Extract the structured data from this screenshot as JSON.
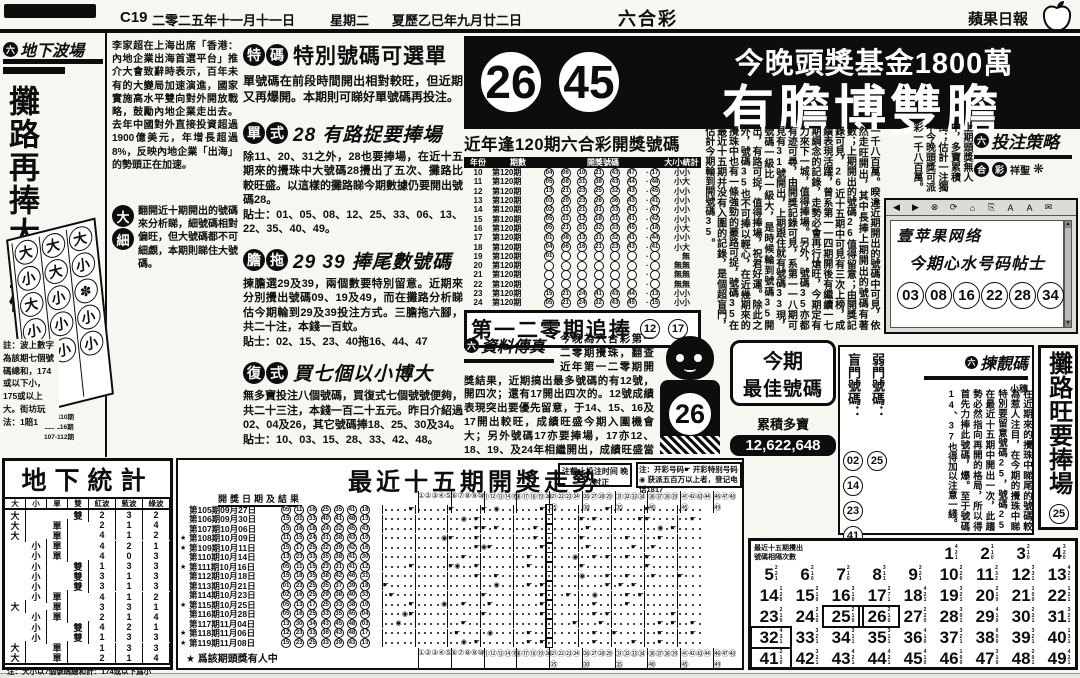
{
  "palette": {
    "ink": "#0d0d0d",
    "paper": "#f7f6f1"
  },
  "header": {
    "page": "C19",
    "date": "二零二五年十一月十一日",
    "weekday": "星期二",
    "lunar": "夏歷乙巳年九月廿二日",
    "section": "六合彩",
    "paper_name": "蘋果日報"
  },
  "left": {
    "logo_prefix": "六",
    "logo": "地下波場",
    "title": "攤路再捧大號碼",
    "board": {
      "rows": [
        [
          "大",
          "大",
          "大"
        ],
        [
          "小",
          "大",
          "小"
        ],
        [
          "大",
          "小",
          "✽"
        ],
        [
          "小",
          "小",
          "小"
        ],
        [
          "小",
          "小",
          "小"
        ]
      ],
      "labels": [
        "105-110期",
        "111-116期",
        "107-112期"
      ]
    },
    "note": "註：波上數字為該期七個號碼總和，174或以下小，175或以上大。街坊玩法：1賠1"
  },
  "news": "李家超在上海出席「香港：內地企業出海首選平台」推介大會致辭時表示，百年未有的大變局加速演進，國家實施高水平雙向對外開放戰略，鼓勵內地企業走出去。去年中國對外直接投資超過1900億美元，年增長超過8%，反映內地企業「出海」的勢頭正在加速。",
  "fan": {
    "badge_top": "大",
    "badge_bottom": "細",
    "text": "翻開近十期開出的號碼來分析睇，細號碼相對偏旺，但大號碼都不可細覷，本期則睇住大號碼。"
  },
  "sections": [
    {
      "badge": "特碼",
      "title": "特別號碼可選單",
      "body": "單號碼在前段時間開出相對較旺，但近期又再爆開。本期則可睇好單號碼再投注。",
      "tips": ""
    },
    {
      "badge": "單式",
      "title": "28 有路捉要捧場",
      "body": "除11、20、31之外，28也要捧場，在近十五期來的攪珠中大號碼28攪出了五次、攤路比較旺盛。以這樣的攤路睇今期數據仍要開出號碼28。",
      "tips": "貼士：01、05、08、12、25、33、06、13、22、35、40、49。"
    },
    {
      "badge": "膽拖",
      "title": "29 39 捧尾數號碼",
      "body": "揀膽選29及39，兩個數要特別留意。近期來分別攪出號碼09、19及49，而在攤路分析睇估今期輪到29及39投注方式。三膽拖六腳，共二十注，本錢一百蚊。",
      "tips": "貼士：02、15、23、40拖16、44、47"
    },
    {
      "badge": "復式",
      "title": "買七個以小博大",
      "body": "無多寶投注八個號碼，買復式七個號號便夠，共二十三注，本錢一百二十五元。昨日介紹過02、04及26，其它號碼捧18、25、30及34。",
      "tips": "貼士：10、03、15、28、33、42、48。"
    }
  ],
  "banner": {
    "balls": [
      "26",
      "45"
    ],
    "line1": "今晚頭獎基金1800萬",
    "line2": "有膽博雙膽"
  },
  "l120": {
    "title": "近年逢120期六合彩開獎號碼",
    "headers": [
      "年份",
      "期數",
      "開獎號碼",
      "大/小統計"
    ],
    "rows": [
      {
        "y": "10",
        "i": "第120期",
        "n": [
          "04",
          "06",
          "10",
          "21",
          "43",
          "47"
        ],
        "s": "17",
        "t": "小小"
      },
      {
        "y": "11",
        "i": "第120期",
        "n": [
          "05",
          "08",
          "31",
          "38",
          "43",
          "44"
        ],
        "s": "48",
        "t": "小大"
      },
      {
        "y": "12",
        "i": "第120期",
        "n": [
          "13",
          "21",
          "23",
          "25",
          "32",
          "43"
        ],
        "s": "45",
        "t": "小小"
      },
      {
        "y": "13",
        "i": "第120期",
        "n": [
          "03",
          "20",
          "23",
          "26",
          "36",
          "43"
        ],
        "s": "41",
        "t": "小小"
      },
      {
        "y": "14",
        "i": "第120期",
        "n": [
          "02",
          "11",
          "21",
          "31",
          "33",
          "41"
        ],
        "s": "47",
        "t": "小小"
      },
      {
        "y": "15",
        "i": "第120期",
        "n": [
          "05",
          "11",
          "12",
          "18",
          "31",
          "41"
        ],
        "s": "42",
        "t": "小小"
      },
      {
        "y": "16",
        "i": "第120期",
        "n": [
          "05",
          "21",
          "31",
          "32",
          "33",
          "45"
        ],
        "s": "18",
        "t": "小大"
      },
      {
        "y": "17",
        "i": "第120期",
        "n": [
          "01",
          "08",
          "13",
          "31",
          "32",
          "41"
        ],
        "s": "44",
        "t": "小小"
      },
      {
        "y": "18",
        "i": "第120期",
        "n": [
          "04",
          "06",
          "16",
          "21",
          "23",
          "43"
        ],
        "s": "41",
        "t": "小大"
      },
      {
        "y": "19",
        "i": "第120期",
        "n": [
          "01",
          "",
          "",
          "",
          "",
          ""
        ],
        "s": "",
        "t": "無"
      },
      {
        "y": "20",
        "i": "第120期",
        "n": [
          "",
          "",
          "",
          "",
          "",
          ""
        ],
        "s": "",
        "t": "無無"
      },
      {
        "y": "21",
        "i": "第120期",
        "n": [
          "",
          "",
          "",
          "",
          "",
          ""
        ],
        "s": "",
        "t": "無無"
      },
      {
        "y": "22",
        "i": "第120期",
        "n": [
          "",
          "",
          "",
          "",
          "",
          ""
        ],
        "s": "",
        "t": "無無"
      },
      {
        "y": "23",
        "i": "第120期",
        "n": [
          "15",
          "21",
          "24",
          "41",
          "43",
          "44"
        ],
        "s": "13",
        "t": "小小"
      },
      {
        "y": "24",
        "i": "第120期",
        "n": [
          "05",
          "21",
          "24",
          "32",
          "43",
          "45"
        ],
        "s": "15",
        "t": "小小"
      }
    ],
    "chase": "第一二零期追捧",
    "chase_balls": [
      "12",
      "17"
    ]
  },
  "column_article": "一千八百萬。暌違近期開出的號碼中可見，依然走旺開出，其中長捧上期開出的號碼有著數；上期開出的號碼26值得留意；由開獎記錄可見，26近十五期中可見有三次上榜，成績表現活躍，曾系第一一四期開後有繼續一七期綱念的記錄，走勢必會再行熗旺，今期定有力來下一城，值得捧場。另外，號碼35亦都有迹可尋，由開獎記錄可見，系第一一八期可見有31號開出，上期跟住就有號碼33現，號碼一級比一級大，是時候輪到號碼35開出，有路可捉，值得捧場，祝君好運。除此之外，號碼35也不可捧以輕心，在近幾期來的攪珠中也有一條強勁的叢路可捉，號碼35在最近十五期并没有入圍的記錄，是個超盲門，估計今期輪到開號碼35。",
  "fax": {
    "logo_prefix": "六",
    "logo": "資料傳真",
    "body": "今晚為六合彩第一二零期攪珠，翻查近年第一二零期開獎結果，近期搞出最多號碼的有12號，開四次；還有17開出四次的。12號成績表現突出要優先留意，于14、15、16及17開出較旺，成績旺盛今期入圍機會大；另外號碼17亦要捧場，17亦12、18、19、及24年相繼開出，成績旺盛當為首選。",
    "best_line1": "今期",
    "best_line2": "最佳號碼",
    "jackpot_label": "累積多寶",
    "jackpot": "12,622,648",
    "boy_number": "26"
  },
  "strategy": {
    "snippet": "上期頭獎無人中，多寶累積萬；估計一注獨中今晚頭獎可派彩一千八百萬。",
    "logo_prefix": "六",
    "logo": "投注策略",
    "sub1": "合",
    "sub2": "彩",
    "sub3": "祥聖"
  },
  "web": {
    "site": "壹苹果网络",
    "title": "今期心水号码帖士",
    "numbers": [
      "03",
      "08",
      "16",
      "22",
      "28",
      "34"
    ],
    "toolbar": [
      "◀",
      "▶",
      "⊗",
      "⟳",
      "⌂",
      "⎘",
      "A",
      "A",
      "✉"
    ]
  },
  "pick": {
    "logo_prefix": "六",
    "logo": "揀靚碼",
    "author": "小穗",
    "blind_label": "盲門號碼：",
    "blind": [
      "02",
      "14",
      "23",
      "41"
    ],
    "weak_label": "弱門號碼：",
    "weak": "25",
    "article": "在近期來的攪珠中睇尾的號碼較為惹人注目，在今期的攪珠中睇特別要留意號碼25，號碼25在最近十五期中開出一次，此趨勢必然指向再開的格局，所以得首先力捧此號碼，爆。至于號碼14、37也得加以注意一綫。"
  },
  "strip": {
    "title": "攤路旺要捧場",
    "number": "25"
  },
  "underground": {
    "title": "地下統計",
    "headers": [
      "大",
      "小",
      "單",
      "雙",
      "紅波",
      "藍波",
      "綠波"
    ],
    "rows": [
      [
        "大",
        "",
        "",
        "雙",
        "2",
        "3",
        "2"
      ],
      [
        "大",
        "",
        "單",
        "",
        "2",
        "1",
        "4"
      ],
      [
        "大",
        "",
        "單",
        "",
        "4",
        "1",
        "2"
      ],
      [
        "",
        "小",
        "單",
        "",
        "4",
        "2",
        "1"
      ],
      [
        "",
        "小",
        "單",
        "",
        "4",
        "0",
        "3"
      ],
      [
        "",
        "小",
        "",
        "雙",
        "1",
        "3",
        "3"
      ],
      [
        "",
        "小",
        "",
        "雙",
        "3",
        "1",
        "3"
      ],
      [
        "",
        "小",
        "",
        "雙",
        "3",
        "1",
        "3"
      ],
      [
        "",
        "小",
        "單",
        "",
        "4",
        "1",
        "2"
      ],
      [
        "大",
        "",
        "單",
        "",
        "3",
        "3",
        "1"
      ],
      [
        "",
        "小",
        "單",
        "",
        "2",
        "1",
        "4"
      ],
      [
        "",
        "小",
        "",
        "雙",
        "4",
        "2",
        "1"
      ],
      [
        "",
        "小",
        "",
        "雙",
        "1",
        "3",
        "3"
      ],
      [
        "大",
        "",
        "單",
        "",
        "1",
        "3",
        "3"
      ],
      [
        "大",
        "",
        "單",
        "",
        "2",
        "1",
        "4"
      ]
    ],
    "note": "注：大小以7個號碼總和計：174或以下爲小"
  },
  "walk": {
    "title": "最近十五期開獎走勢",
    "col_header": "開獎日期及結果",
    "note1": "注：开彩号码☛ 开彩特别号码◉ 获派五百万以上者，登记电话1817",
    "note2": "注截止投注时间 晚上7时正",
    "star_note": "★  爲該期頭獎有人中",
    "rows": [
      {
        "star": false,
        "date": "第105期09月27日",
        "n": [
          5,
          11,
          16,
          25,
          35,
          41
        ],
        "s": 18
      },
      {
        "star": false,
        "date": "第106期09月30日",
        "n": [
          15,
          31,
          33,
          40,
          41,
          48
        ],
        "s": 13
      },
      {
        "star": false,
        "date": "第107期10月06日",
        "n": [
          15,
          16,
          18,
          24,
          32,
          45
        ],
        "s": 43
      },
      {
        "star": true,
        "date": "第108期10月09日",
        "n": [
          11,
          15,
          24,
          31,
          38,
          43
        ],
        "s": 10
      },
      {
        "star": true,
        "date": "第109期10月11日",
        "n": [
          15,
          17,
          25,
          32,
          39,
          42
        ],
        "s": 16
      },
      {
        "star": false,
        "date": "第110期10月14日",
        "n": [
          13,
          23,
          33,
          35,
          38,
          41
        ],
        "s": 30
      },
      {
        "star": true,
        "date": "第111期10月16日",
        "n": [
          5,
          11,
          15,
          23,
          31,
          41
        ],
        "s": 12
      },
      {
        "star": false,
        "date": "第112期10月18日",
        "n": [
          15,
          18,
          35,
          38,
          42,
          46
        ],
        "s": 31
      },
      {
        "star": false,
        "date": "第113期10月21日",
        "n": [
          1,
          23,
          25,
          35,
          37,
          39
        ],
        "s": 18
      },
      {
        "star": false,
        "date": "第114期10月23日",
        "n": [
          2,
          16,
          25,
          29,
          38,
          40
        ],
        "s": 33
      },
      {
        "star": true,
        "date": "第115期10月25日",
        "n": [
          5,
          13,
          17,
          25,
          33,
          38
        ],
        "s": 10
      },
      {
        "star": false,
        "date": "第116期10月28日",
        "n": [
          5,
          16,
          25,
          33,
          35,
          45
        ],
        "s": 4
      },
      {
        "star": false,
        "date": "第117期11月04日",
        "n": [
          13,
          30,
          34,
          43,
          45,
          48
        ],
        "s": 3
      },
      {
        "star": true,
        "date": "第118期11月06日",
        "n": [
          12,
          23,
          33,
          36,
          43,
          48
        ],
        "s": 17
      },
      {
        "star": true,
        "date": "第119期11月08日",
        "n": [
          15,
          23,
          25,
          33,
          39,
          43
        ],
        "s": 13
      }
    ],
    "highlight_column": 26
  },
  "freq": {
    "header1": "最近十五期攪出",
    "header2": "號碼相隔次數",
    "counts": [
      "421",
      "110",
      "210",
      "320",
      "221",
      "210",
      "210",
      "311",
      "221",
      "220",
      "232",
      "331",
      "421",
      "120",
      "210",
      "310",
      "271",
      "421",
      "321",
      "210",
      "100",
      "121",
      "210",
      "210",
      "210",
      "210",
      "220",
      "301",
      "410",
      "221",
      "321",
      "431",
      "321",
      "311",
      "311",
      "410",
      "321",
      "000",
      "321",
      "131",
      "210",
      "321",
      "421",
      "421",
      "410",
      "100",
      "310",
      "201",
      "421"
    ],
    "boxed": [
      25,
      26,
      32,
      41
    ]
  }
}
